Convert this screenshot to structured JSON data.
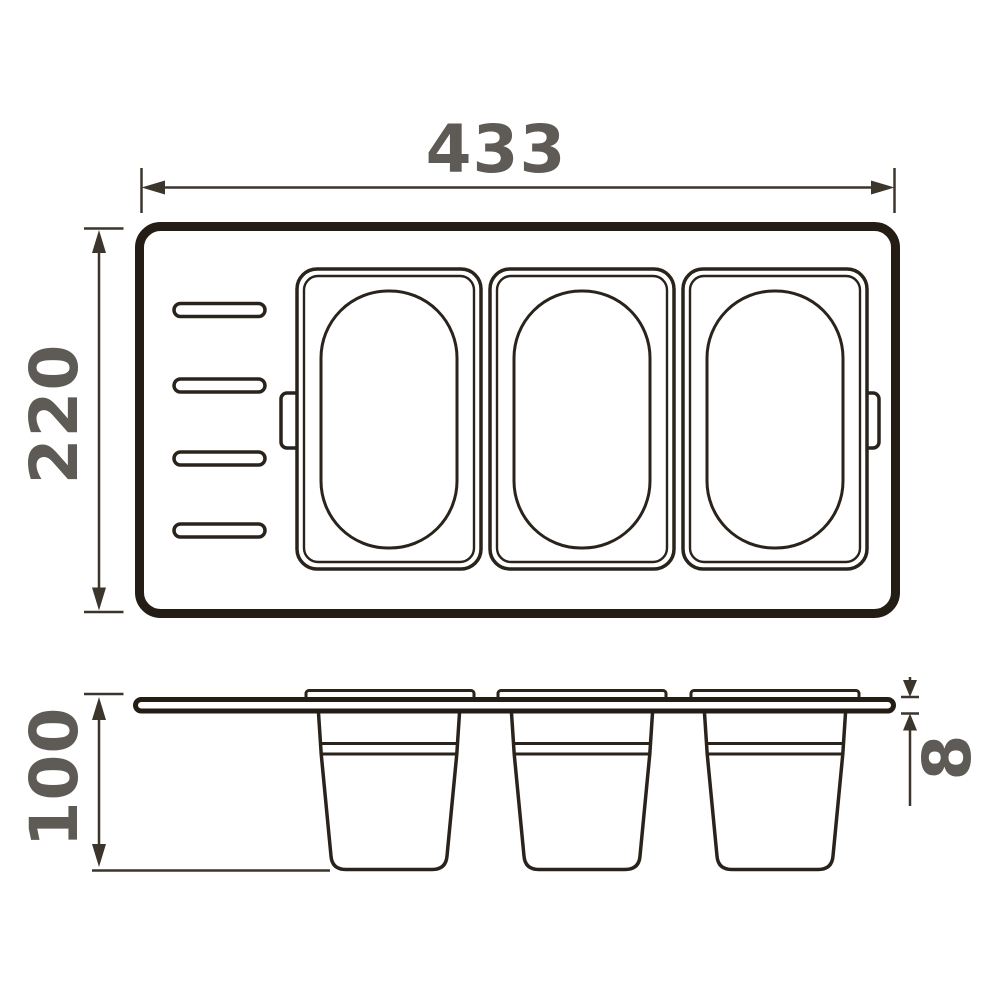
{
  "dimensions": {
    "width_label": "433",
    "depth_label": "220",
    "height_label": "100",
    "thickness_label": "8"
  },
  "structure": {
    "top_view": {
      "containers": 3,
      "slots": 4,
      "handle_tabs": 2
    },
    "side_view": {
      "tubs": 3,
      "rims": 3
    }
  },
  "colors": {
    "outline_dark": "#241d15",
    "line_medium": "#2a231b",
    "dimension_line": "#3c352c",
    "dimension_text": "#5e5b56",
    "background": "#ffffff"
  }
}
